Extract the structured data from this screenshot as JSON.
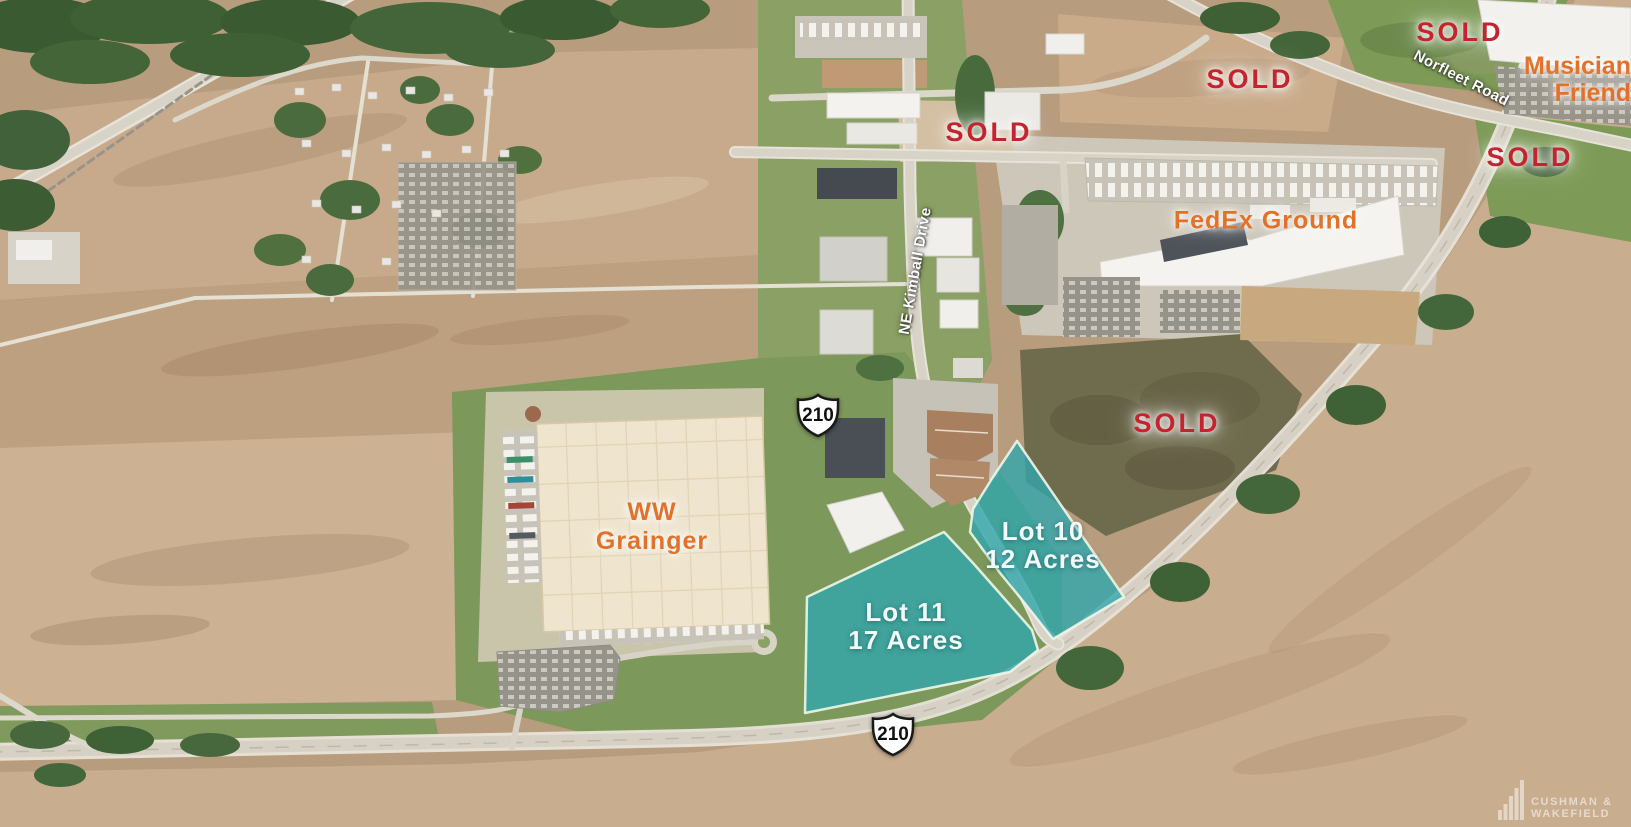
{
  "map": {
    "status_labels": {
      "sold": "SOLD"
    },
    "property_labels": {
      "musician": {
        "line1": "Musician",
        "line2": "Friend"
      },
      "fedex": "FedEx Ground",
      "grainger": {
        "line1": "WW",
        "line2": "Grainger"
      }
    },
    "road_labels": {
      "norfleet": "Norfleet Road",
      "kimball": "NE Kimball Drive"
    },
    "route_shield": "210",
    "lots": [
      {
        "name": "Lot 10",
        "size": "12 Acres"
      },
      {
        "name": "Lot 11",
        "size": "17 Acres"
      }
    ],
    "watermark": {
      "line1": "CUSHMAN &",
      "line2": "WAKEFIELD"
    },
    "colors": {
      "sold_red": "#C5242F",
      "label_orange": "#E2722B",
      "lot_teal": "#31A6AD",
      "road_label_white": "#FFFFFF"
    }
  }
}
